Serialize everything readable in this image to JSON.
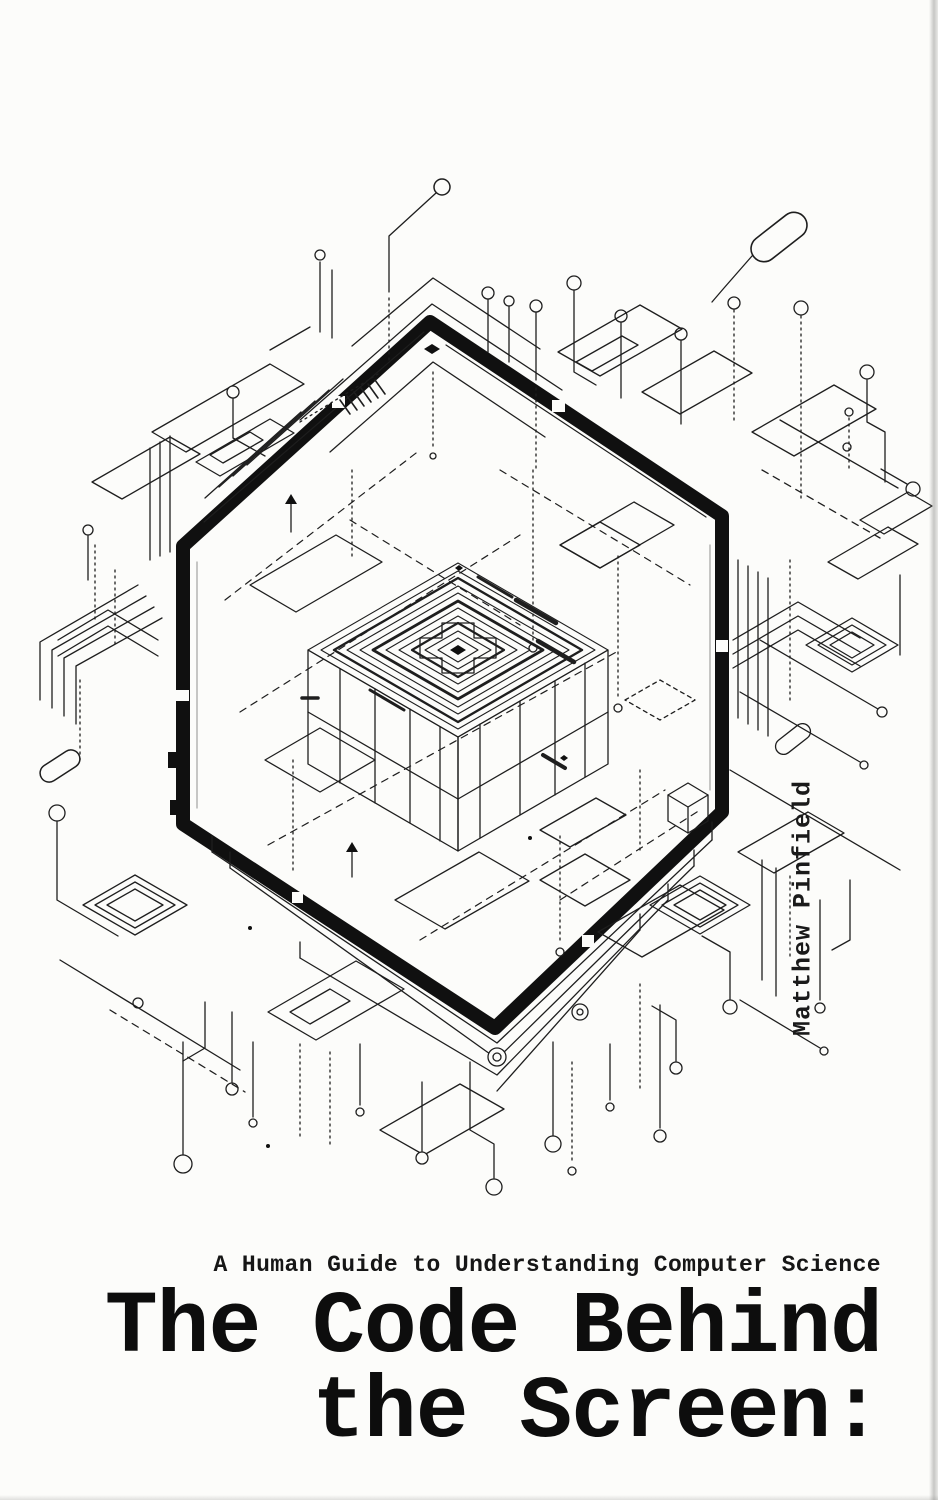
{
  "cover": {
    "author": "Matthew Pinfield",
    "subtitle": "A Human Guide to Understanding Computer Science",
    "title": {
      "line1": "The Code Behind",
      "line2": "the Screen:"
    },
    "colors": {
      "background": "#fcfcfa",
      "ink": "#1a1a1a",
      "hexagon_band": "#111111",
      "edge_shadow": "#9a9a98"
    }
  }
}
